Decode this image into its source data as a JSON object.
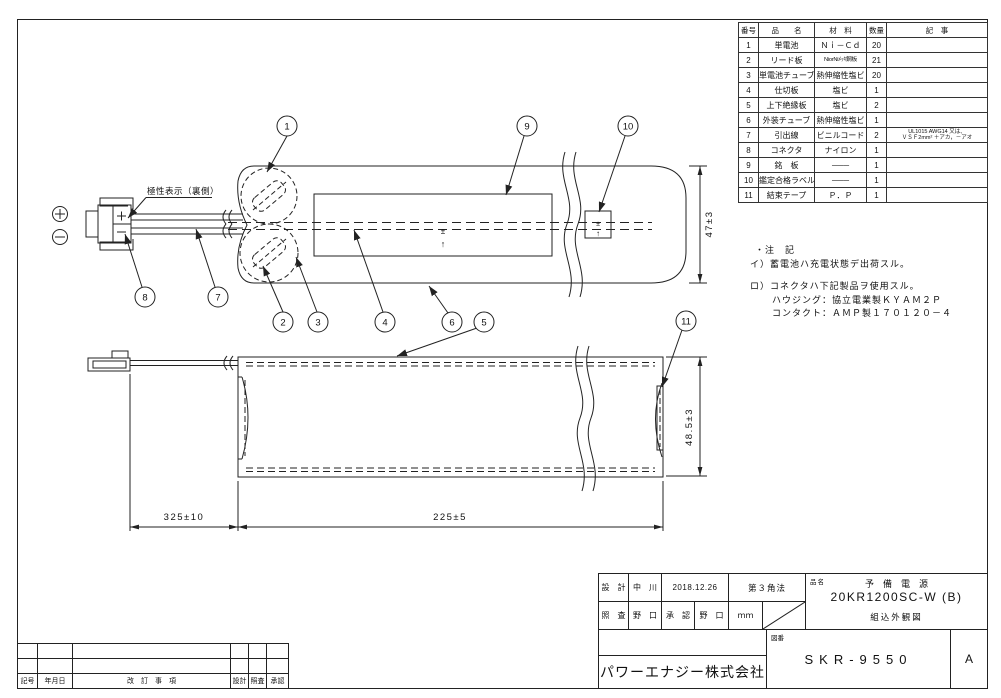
{
  "parts_table": {
    "headers": {
      "no": "番号",
      "name": "品　　名",
      "material": "材　料",
      "qty": "数量",
      "remarks": "記　事"
    },
    "rows": [
      {
        "no": "1",
        "name": "単電池",
        "material": "Ｎｉ－Ｃｄ",
        "qty": "20",
        "remarks": ""
      },
      {
        "no": "2",
        "name": "リード板",
        "material": "NiorNiﾒｯｷ鋼板",
        "qty": "21",
        "remarks": ""
      },
      {
        "no": "3",
        "name": "単電池チューブ",
        "material": "熱伸縮性塩ビ",
        "qty": "20",
        "remarks": ""
      },
      {
        "no": "4",
        "name": "仕切板",
        "material": "塩ビ",
        "qty": "1",
        "remarks": ""
      },
      {
        "no": "5",
        "name": "上下絶縁板",
        "material": "塩ビ",
        "qty": "2",
        "remarks": ""
      },
      {
        "no": "6",
        "name": "外装チューブ",
        "material": "熱伸縮性塩ビ",
        "qty": "1",
        "remarks": ""
      },
      {
        "no": "7",
        "name": "引出線",
        "material": "ビニルコード",
        "qty": "2",
        "remarks": "UL1015 AWG14 又は、",
        "remarks2": "ＶＳＦ2mm² ＋アカ，－アオ"
      },
      {
        "no": "8",
        "name": "コネクタ",
        "material": "ナイロン",
        "qty": "1",
        "remarks": ""
      },
      {
        "no": "9",
        "name": "銘　板",
        "material": "───",
        "qty": "1",
        "remarks": ""
      },
      {
        "no": "10",
        "name": "鑑定合格ラベル",
        "material": "───",
        "qty": "1",
        "remarks": ""
      },
      {
        "no": "11",
        "name": "結束テープ",
        "material": "Ｐ．Ｐ",
        "qty": "1",
        "remarks": ""
      }
    ]
  },
  "notes": {
    "title": "・注　記",
    "a": "イ）蓄電池ハ充電状態デ出荷スル。",
    "b": "ロ）コネクタハ下記製品ヲ使用スル。",
    "b1": "ハウジング：協立電業製ＫＹＡＭ２Ｐ",
    "b2": "コンタクト：ＡＭＰ製１７０１２０－４"
  },
  "drawing": {
    "polarity_label": "極性表示（裏側）",
    "callouts": [
      "1",
      "2",
      "3",
      "4",
      "5",
      "6",
      "7",
      "8",
      "9",
      "10",
      "11"
    ],
    "dims": {
      "height_top": "47±3",
      "height_bottom": "48.5±3",
      "lead_length": "325±10",
      "body_length": "225±5"
    },
    "plus_mark": "±",
    "up_arrow": "↑"
  },
  "title_block": {
    "design_label": "設　計",
    "designer": "中　川",
    "date": "2018.12.26",
    "projection": "第３角法",
    "check_label": "照　査",
    "checker": "野　口",
    "approve_label": "承　認",
    "approver": "野　口",
    "unit": "ｍｍ",
    "part_name_label": "品名",
    "part_name": "予　備　電　源",
    "model": "20KR1200SC-W (B)",
    "doc_type": "組込外観図",
    "company": "パワーエナジー株式会社",
    "drawing_no_label": "図番",
    "drawing_no": "SKR-9550",
    "revision": "A"
  },
  "revision_table": {
    "sign": "記号",
    "date": "年月日",
    "item": "改　訂　事　項",
    "design": "設計",
    "check": "照査",
    "approve": "承認"
  }
}
